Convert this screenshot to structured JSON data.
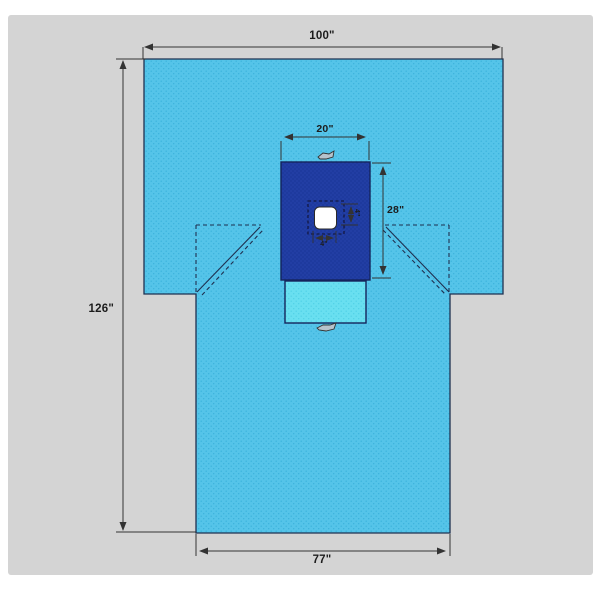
{
  "diagram": {
    "dimensions": {
      "overall_width": "100\"",
      "overall_length": "126\"",
      "bottom_width": "77\"",
      "reinforcement_width": "20\"",
      "reinforcement_height": "28\"",
      "fenestration_height": "4\"",
      "fenestration_width": "4\""
    },
    "colors": {
      "canvas": "#d4d4d4",
      "drape": "#55c4e9",
      "drape_dot": "#3ab2dc",
      "reinforcement": "#1e3a9e",
      "reinforcement_dot": "#2a49b5",
      "pouch": "#69dff0",
      "pouch_dot": "#4fd0e6",
      "fenestration": "#ffffff",
      "line": "#333333",
      "outline": "#1f3050"
    }
  }
}
